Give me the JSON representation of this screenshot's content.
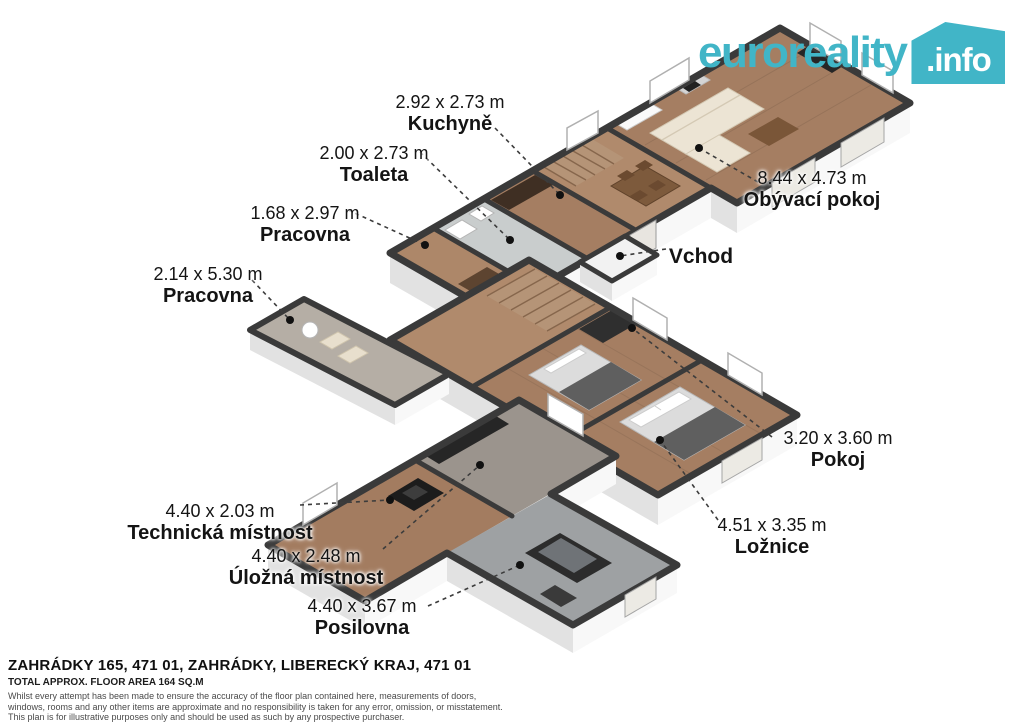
{
  "logo": {
    "brand": "euroreality",
    "tld": ".info",
    "color": "#41b5c7"
  },
  "labels": {
    "entrance": "Vchod",
    "rooms": [
      {
        "key": "kuchyne",
        "dims": "2.92 x 2.73 m",
        "name": "Kuchyně"
      },
      {
        "key": "toaleta",
        "dims": "2.00 x 2.73 m",
        "name": "Toaleta"
      },
      {
        "key": "pracovna-horni",
        "dims": "1.68 x 2.97 m",
        "name": "Pracovna"
      },
      {
        "key": "pracovna-dolni",
        "dims": "2.14 x 5.30 m",
        "name": "Pracovna"
      },
      {
        "key": "obyvaci-pokoj",
        "dims": "8.44 x 4.73 m",
        "name": "Obývací pokoj"
      },
      {
        "key": "pokoj",
        "dims": "3.20 x 3.60 m",
        "name": "Pokoj"
      },
      {
        "key": "loznice",
        "dims": "4.51 x 3.35 m",
        "name": "Ložnice"
      },
      {
        "key": "technicka-mistnost",
        "dims": "4.40 x 2.03 m",
        "name": "Technická místnost"
      },
      {
        "key": "ulozna-mistnost",
        "dims": "4.40 x 2.48 m",
        "name": "Úložná místnost"
      },
      {
        "key": "posilovna",
        "dims": "4.40 x 3.67 m",
        "name": "Posilovna"
      }
    ]
  },
  "footer": {
    "address": "ZAHRÁDKY 165, 471 01, ZAHRÁDKY, LIBERECKÝ KRAJ, 471 01",
    "area": "TOTAL APPROX. FLOOR AREA 164 SQ.M",
    "disclaimer": [
      "Whilst every attempt has been made to ensure the accuracy of the floor plan contained here, measurements of doors,",
      "windows, rooms and any other items are approximate and no responsibility is taken for any error, omission, or misstatement.",
      "This plan is for illustrative purposes only and should be used as such by any prospective purchaser."
    ]
  }
}
